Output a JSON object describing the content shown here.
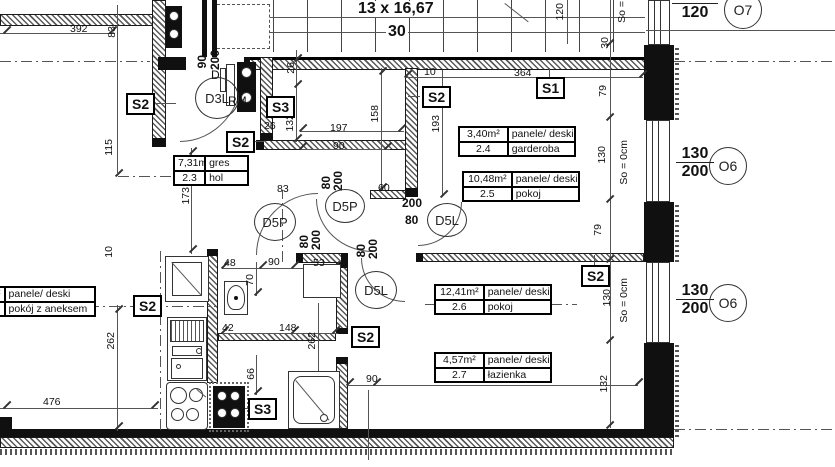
{
  "stairs": {
    "label": "13 x 16,67",
    "width": "30"
  },
  "rooms": [
    {
      "area": "7,31m²",
      "finish": "gres",
      "number": "2.3",
      "name": "hol"
    },
    {
      "area": "3,40m²",
      "finish": "panele/ deski",
      "number": "2.4",
      "name": "garderoba"
    },
    {
      "area": "10,48m²",
      "finish": "panele/ deski",
      "number": "2.5",
      "name": "pokoj"
    },
    {
      "area": "12,41m²",
      "finish": "panele/ deski",
      "number": "2.6",
      "name": "pokoj"
    },
    {
      "area": "4,57m²",
      "finish": "panele/ deski",
      "number": "2.7",
      "name": "łazienka"
    },
    {
      "area": "m²",
      "finish": "panele/ deski",
      "number": "",
      "name": "pokój z aneksem"
    }
  ],
  "walls": [
    "S2",
    "S2",
    "S3",
    "S2",
    "S1",
    "S2",
    "S2",
    "S2",
    "S3"
  ],
  "doors": [
    "D3L",
    "D5P",
    "D5P",
    "D5L",
    "D5L"
  ],
  "annotations": {
    "d": "D",
    "rm": "RM"
  },
  "windows": [
    {
      "w": "120",
      "h": "120",
      "sym": "O7"
    },
    {
      "w": "130",
      "h": "200",
      "sym": "O6"
    },
    {
      "w": "130",
      "h": "200",
      "sym": "O6"
    }
  ],
  "sills": [
    "So =",
    "So = 0cm",
    "So = 0cm"
  ],
  "dims": [
    "392",
    "83",
    "115",
    "173",
    "26",
    "132",
    "197",
    "90",
    "158",
    "193",
    "10",
    "364",
    "120",
    "30",
    "79",
    "130",
    "79",
    "130",
    "132",
    "26",
    "48",
    "90",
    "70",
    "53",
    "10",
    "42",
    "148",
    "66",
    "262",
    "262",
    "90",
    "200",
    "80",
    "200",
    "80",
    "200",
    "80",
    "200",
    "200",
    "80",
    "90",
    "381",
    "476",
    "60",
    "83"
  ]
}
